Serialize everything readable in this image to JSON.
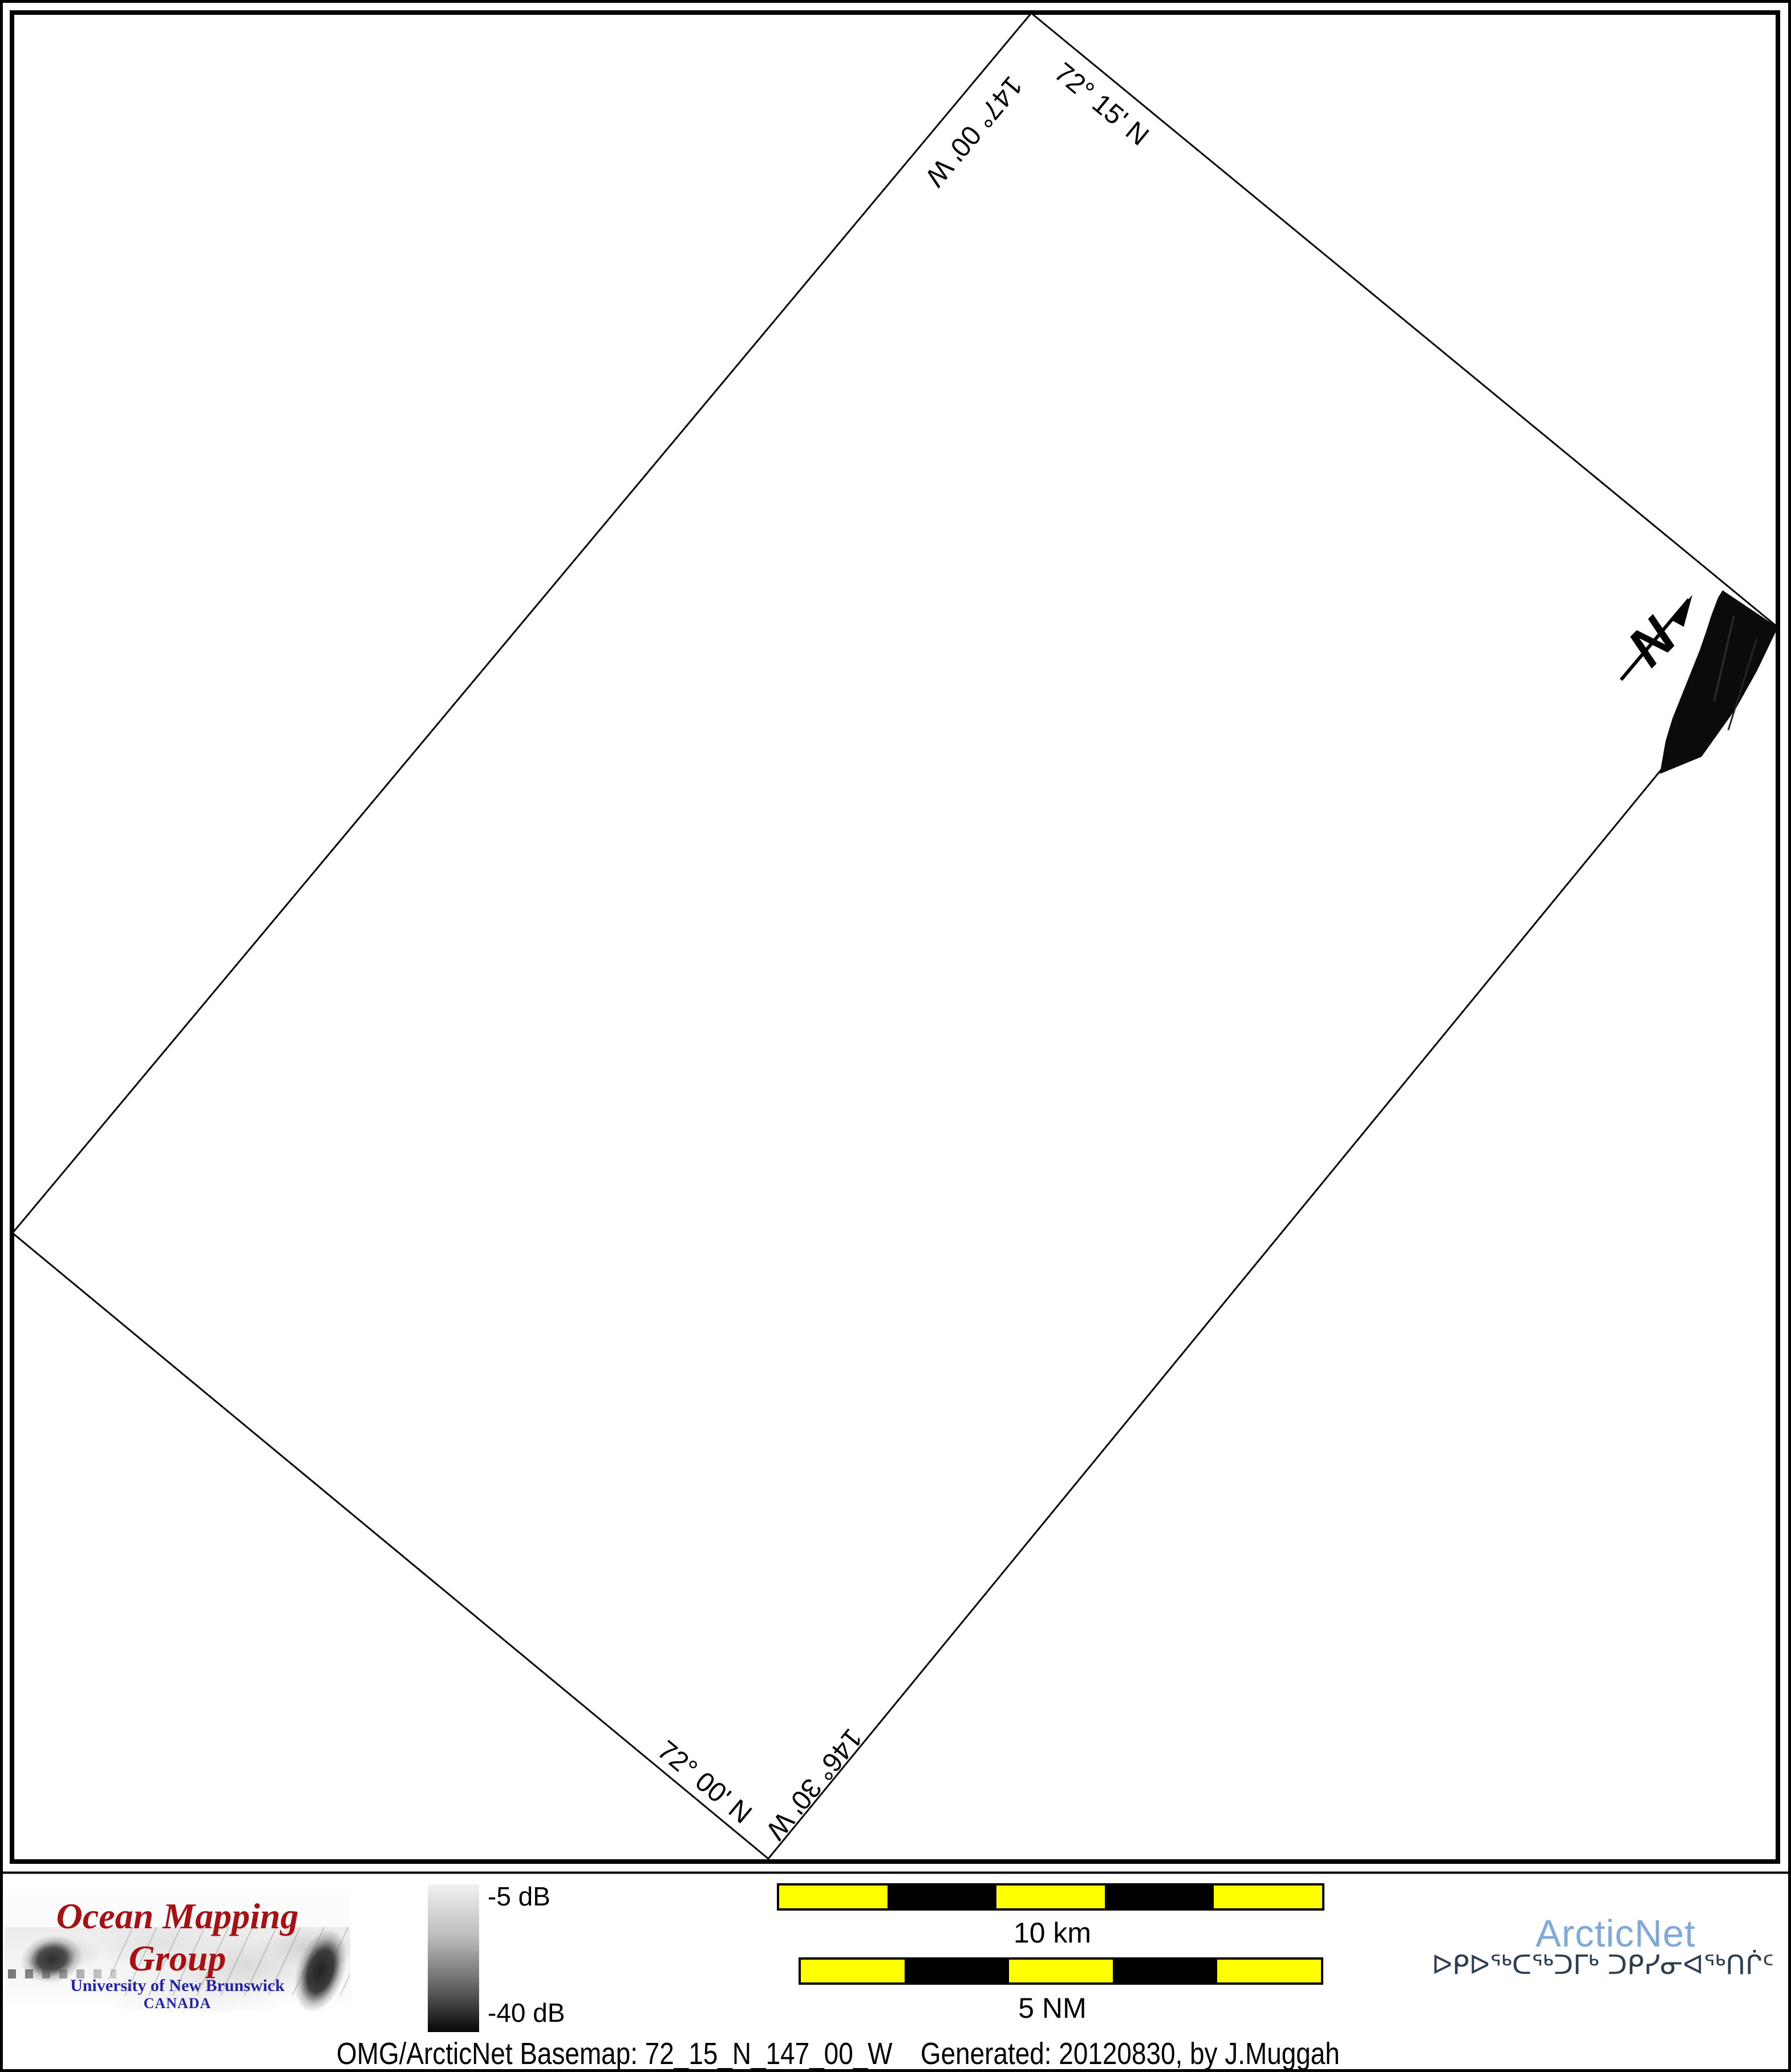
{
  "map": {
    "corner_labels": {
      "west_meridian": "147° 00' W",
      "north_parallel": "72° 15' N",
      "south_parallel": "72° 00' N",
      "east_meridian": "146° 30' W"
    },
    "north_arrow_label": "N"
  },
  "legend": {
    "omg_logo": {
      "title": "Ocean Mapping Group",
      "university": "University of New Brunswick",
      "country": "CANADA"
    },
    "colorbar": {
      "top_label": "-5 dB",
      "bottom_label": "-40 dB",
      "gradient_top_color": "#f1f1f1",
      "gradient_bottom_color": "#060606"
    },
    "scalebars": {
      "km": {
        "label": "10 km",
        "segments": 5
      },
      "nm": {
        "label": "5 NM",
        "segments": 5
      },
      "segment_colors": [
        "#ffff00",
        "#000000"
      ]
    },
    "arcticnet": {
      "name": "ArcticNet",
      "inuktitut": "ᐅᑭᐅᖅᑕᖅᑐᒥᒃ ᑐᑭᓯᓂᐊᖅᑎᒌᑦ",
      "name_color": "#7fa9da",
      "inuktitut_color": "#2d3e52"
    },
    "caption": {
      "basemap": "OMG/ArcticNet Basemap: 72_15_N_147_00_W",
      "generated": "Generated: 20120830, by J.Muggah"
    }
  },
  "colors": {
    "omg_title_red": "#a81114",
    "unb_blue": "#2424a8",
    "scalebar_yellow": "#ffff00",
    "line_black": "#000000"
  }
}
